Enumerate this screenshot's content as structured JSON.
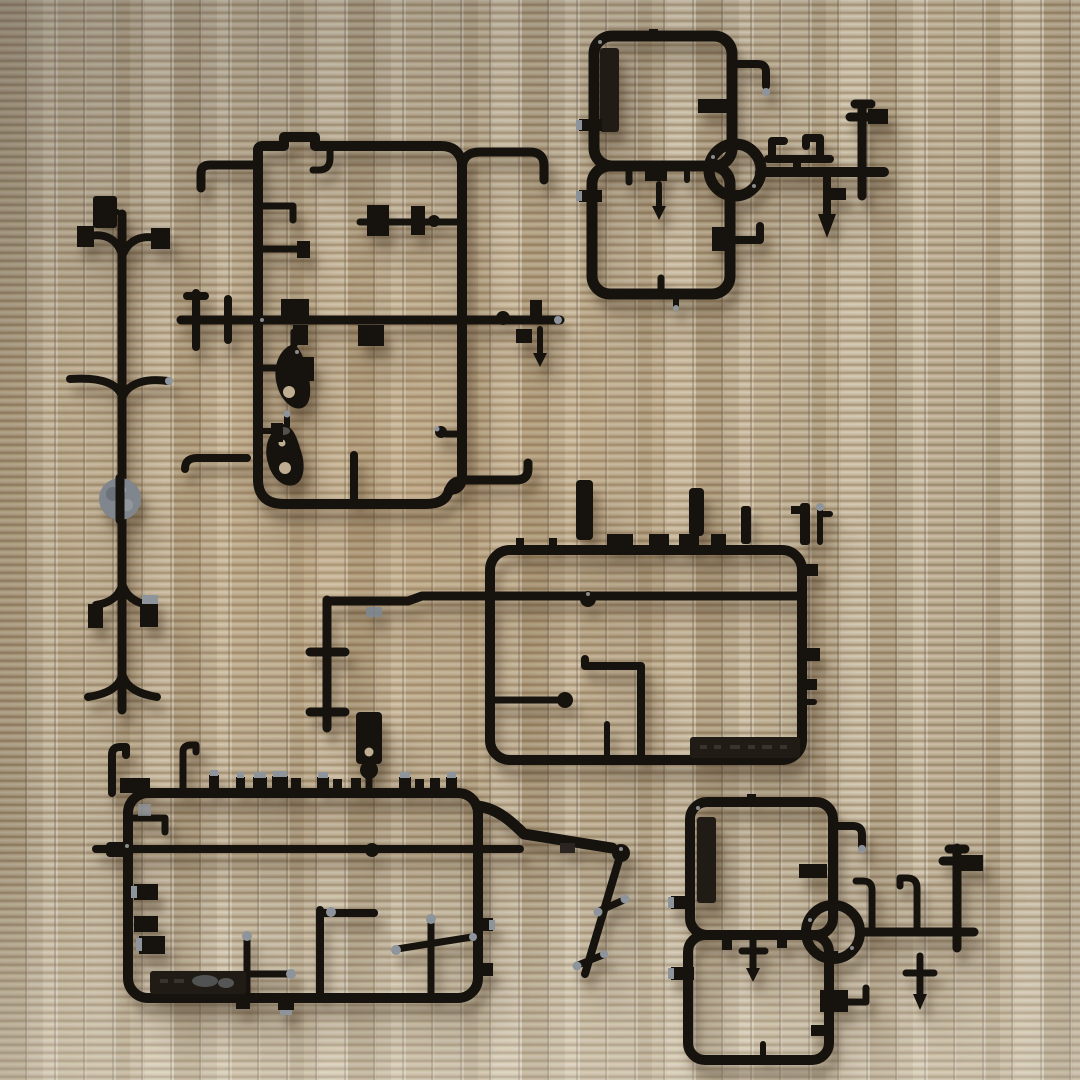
{
  "scene": {
    "type": "photograph",
    "summary": "Top-down photo of six black plastic model-kit part sprues (runners) laid out on a woven tatami mat",
    "surface": {
      "label": "tatami mat",
      "weave": "horizontal straw strands with vertical stitch seams"
    },
    "objects": [
      {
        "id": "sprue-top-right",
        "label": "sprue with two rounded-square frames, a round pole ring and crossed pole parts"
      },
      {
        "id": "sprue-top-middle",
        "label": "tall rectangular sprue with center crossbar, hook parts and two teardrop-shaped parts"
      },
      {
        "id": "sprue-left",
        "label": "tree-shaped vertical sprue with curved branch arms and a gray round disc part"
      },
      {
        "id": "sprue-middle-right",
        "label": "wide rectangular sprue with cylindrical parts on its top rail and a long side bar"
      },
      {
        "id": "sprue-bottom-left",
        "label": "large rectangular sprue with a row of molding tabs, a long through rod and an angled swing arm"
      },
      {
        "id": "sprue-bottom-right",
        "label": "sprue with two rounded-square frames, a round pole ring and crossed pole parts"
      }
    ],
    "details": {
      "embossed_plate_middle": "molded maker text plate (illegible)",
      "embossed_plate_bottom_left": "molded maker text plate (illegible)",
      "gate_marks": "light gray cut gate marks on several part tips",
      "disc_part": "round gray mottled disc on the left sprue"
    }
  },
  "palette": {
    "plastic": "#16120d",
    "plate": "#201b15",
    "gate": "#8d949b",
    "disc": "#7f868d",
    "mat-base": "#bfae92",
    "mat-light": "#d8cbb0",
    "mat-dark": "#8e7c60",
    "shadow": "rgba(64,48,28,0.38)"
  }
}
